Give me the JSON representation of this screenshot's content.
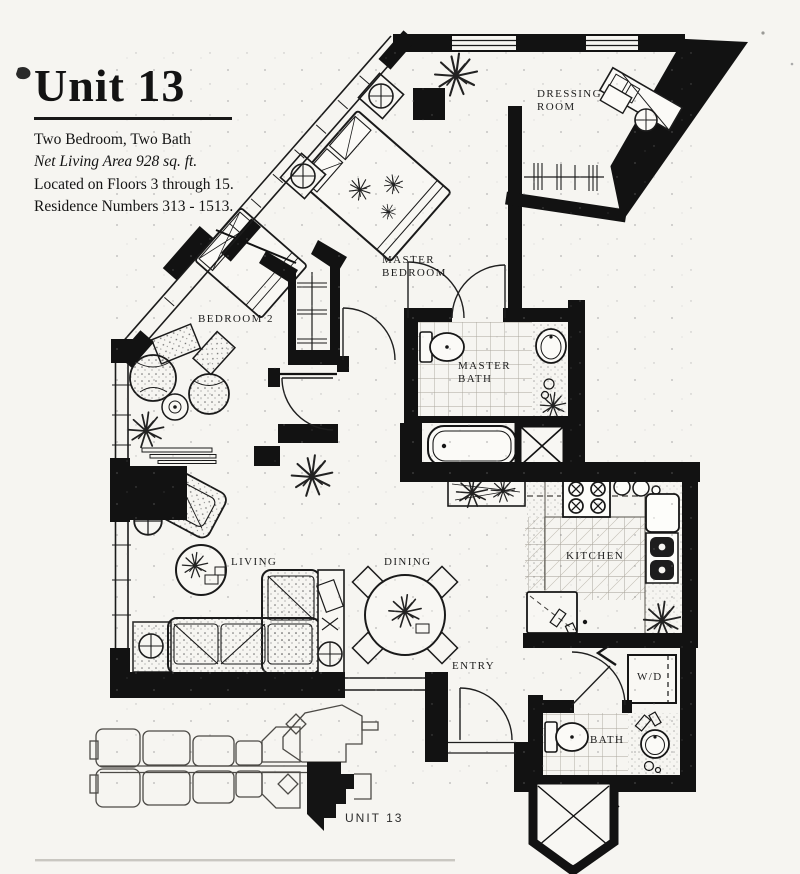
{
  "title_block": {
    "title": "Unit 13",
    "line1": "Two Bedroom, Two Bath",
    "line2": "Net Living Area 928 sq. ft.",
    "line3": "Located on Floors 3 through 15.",
    "line4": "Residence Numbers 313 - 1513."
  },
  "room_labels": {
    "dressing_line1": "DRESSING",
    "dressing_line2": "ROOM",
    "master_bedroom_line1": "MASTER",
    "master_bedroom_line2": "BEDROOM",
    "bedroom2": "BEDROOM 2",
    "master_bath_line1": "MASTER",
    "master_bath_line2": "BATH",
    "living": "LIVING",
    "dining": "DINING",
    "kitchen": "KITCHEN",
    "entry": "ENTRY",
    "washer_dryer": "W/D",
    "bath": "BATH"
  },
  "key_plan": {
    "unit_label": "UNIT 13"
  },
  "colors": {
    "ink": "#141414",
    "paper": "#f6f5f1"
  }
}
